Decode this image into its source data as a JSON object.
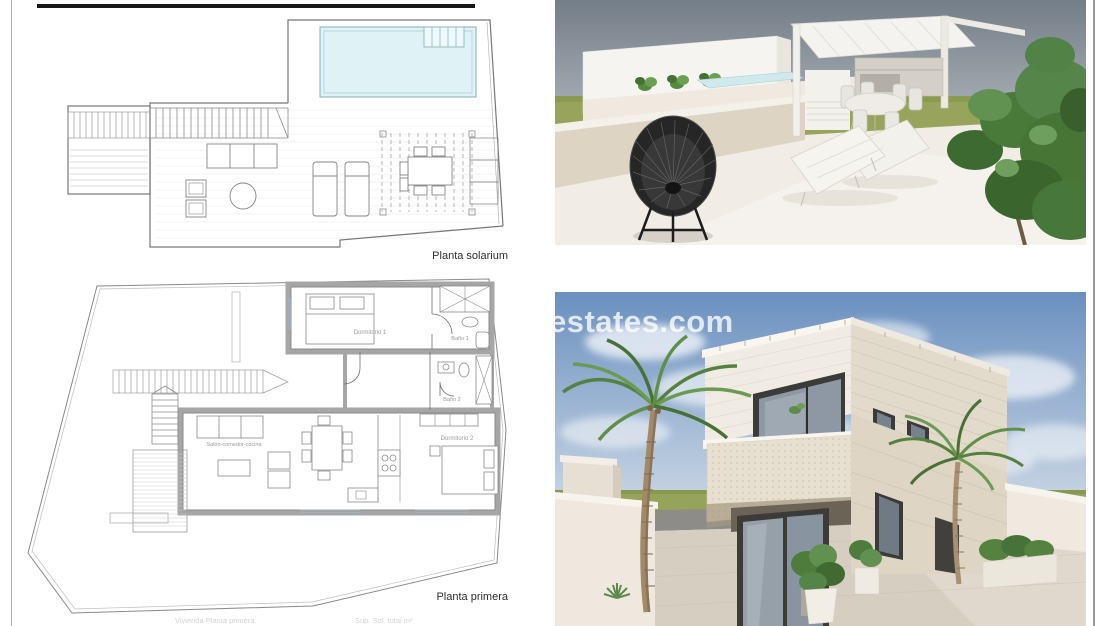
{
  "plans": {
    "solarium_label": "Planta solarium",
    "primera_label": "Planta primera",
    "rooms": {
      "dormitorio1": "Dormitorio 1",
      "bano1": "Baño 1",
      "bano2": "Baño 2",
      "dormitorio2": "Dormitorio 2",
      "salon": "Salón-comedor-cocina"
    },
    "footer": {
      "left": "Vivienda Planta primera",
      "right": "Sup. Sol. total m²"
    }
  },
  "watermark": {
    "text": "estates.com"
  },
  "colors": {
    "pool_fill": "#dff2f5",
    "plan_line": "#777777",
    "wall_grey": "#a6a6a6",
    "sky_grey_top": "#747e88",
    "sky_grey_bottom": "#a9afb6",
    "grass_green": "#98a45c",
    "terrace_floor": "#f1ede6",
    "sky_blue_top": "#6a90c0",
    "sky_blue_bottom": "#c8d5e3",
    "villa_beige": "#e7dfd0",
    "window_frame": "#3b3b39",
    "bush_green": "#4a7a3a",
    "palm_green": "#55813f"
  }
}
